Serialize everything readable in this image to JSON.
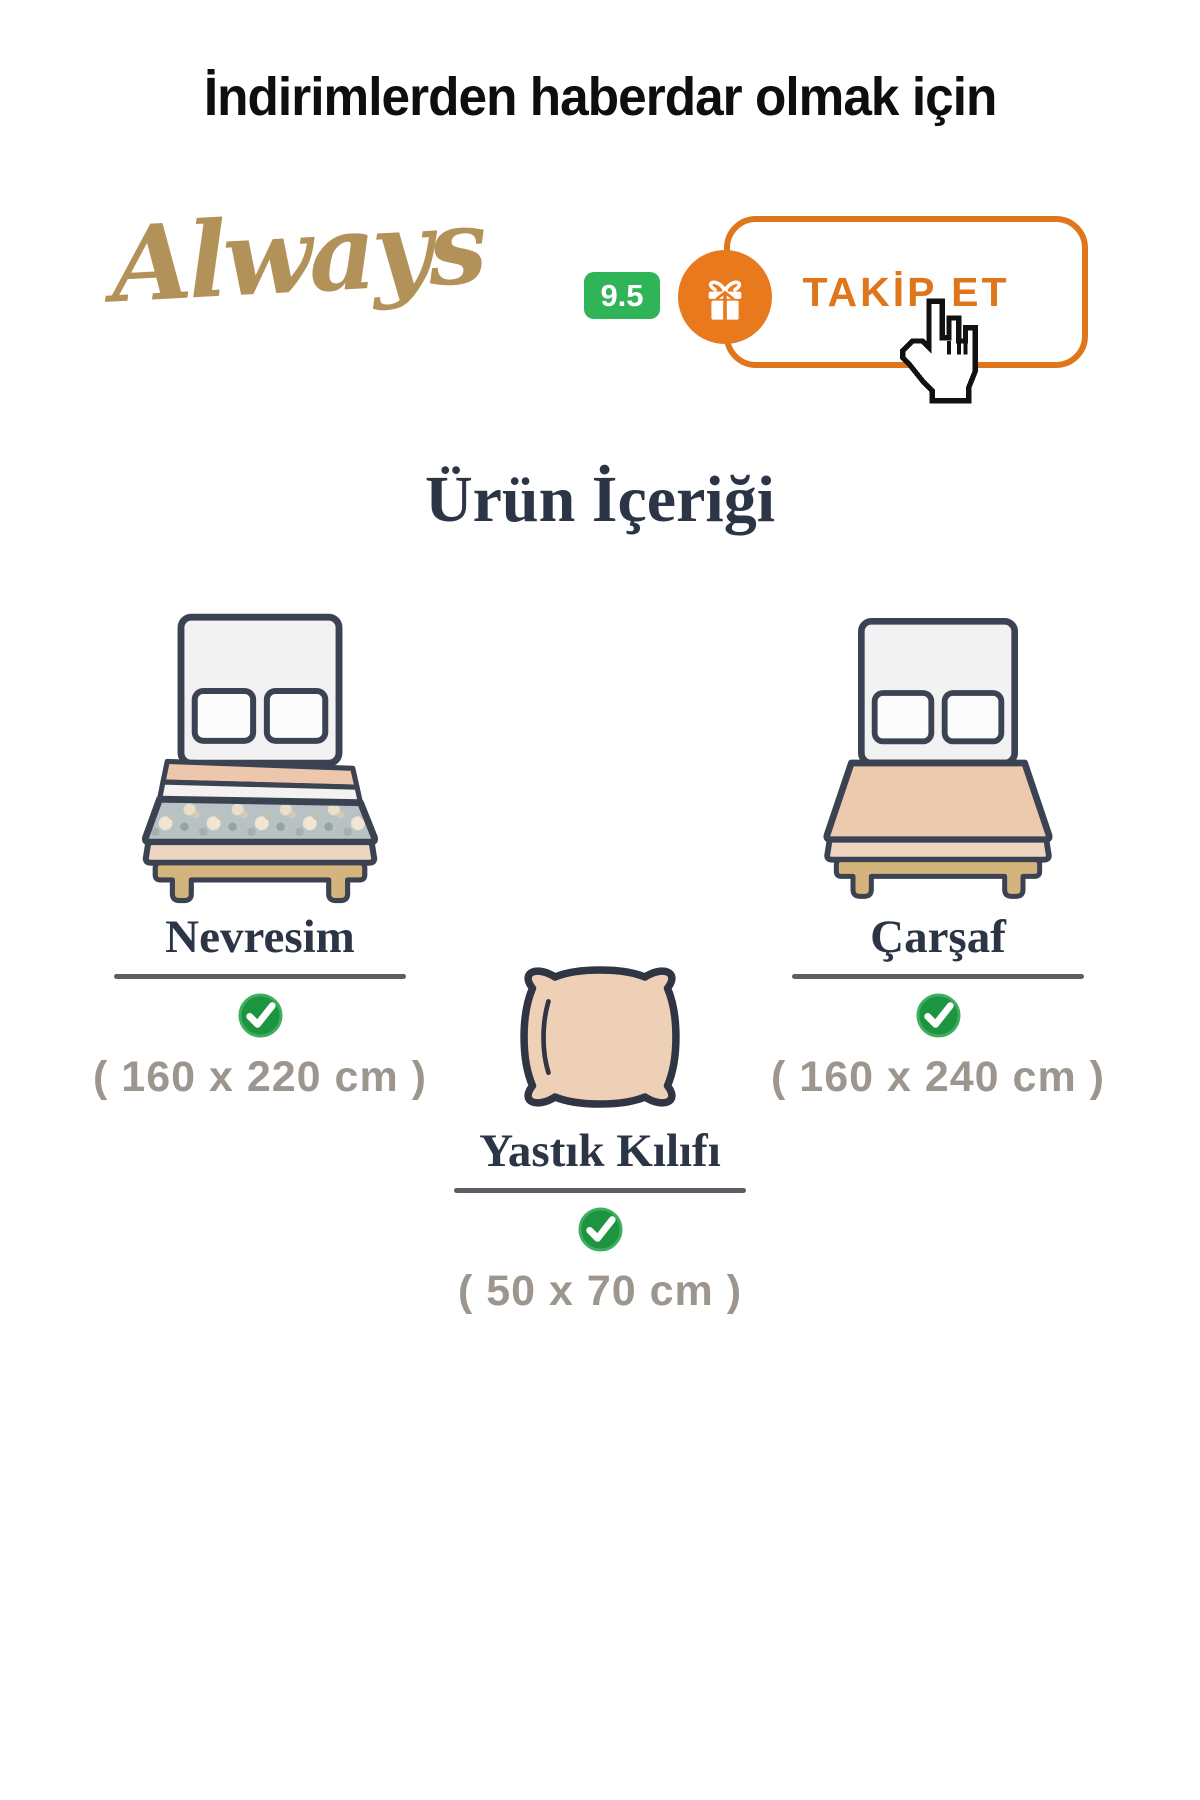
{
  "header": {
    "title": "İndirimlerden haberdar olmak için"
  },
  "seller": {
    "brand_name": "Always",
    "rating": "9.5",
    "follow_button": "TAKİP ET"
  },
  "section_title": "Ürün İçeriği",
  "items": [
    {
      "name": "Nevresim",
      "size": "( 160 x 220 cm )",
      "included": true
    },
    {
      "name": "Çarşaf",
      "size": "( 160 x 240 cm )",
      "included": true
    },
    {
      "name": "Yastık Kılıfı",
      "size": "( 50 x 70 cm )",
      "included": true
    }
  ],
  "colors": {
    "accent_orange": "#e0761c",
    "rating_green": "#2fb457",
    "check_green": "#1d9440",
    "brand_gold": "#b3925a",
    "heading_navy": "#2c3545",
    "size_gray": "#9c968e"
  }
}
